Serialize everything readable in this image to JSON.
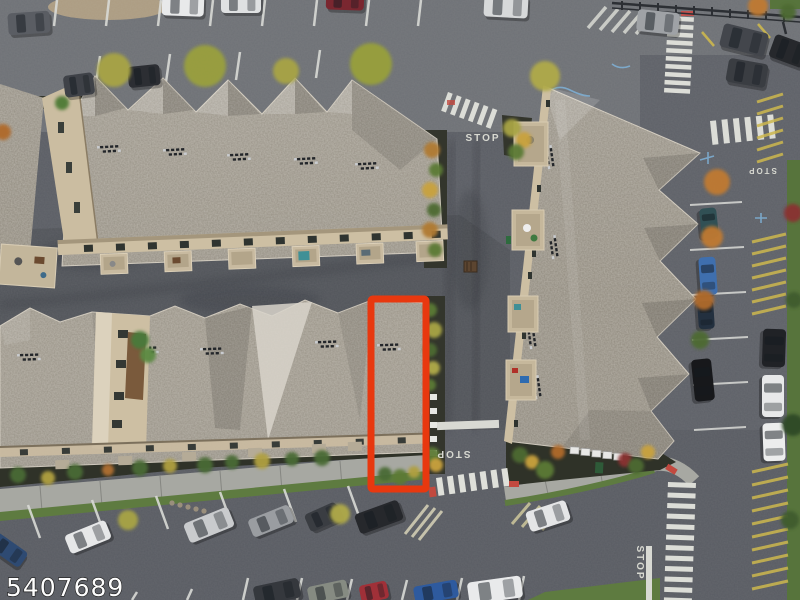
{
  "scene": {
    "description": "Aerial drone photo of a townhome community with gray shingle roofs, parking lots, roads with STOP markings and crosswalks; one townhouse unit is outlined with a red rectangle",
    "width": 800,
    "height": 600
  },
  "watermark": {
    "text": "5407689"
  },
  "highlight_box": {
    "color": "#e8380f",
    "x": 371,
    "y": 299,
    "width": 55,
    "height": 190,
    "stroke_width": 7
  },
  "road_markings": {
    "stop_label": "STOP",
    "stop_instances": 4,
    "marking_white": "#dcddd7",
    "curb_yellow": "#cdb84e",
    "curb_red": "#c2493f",
    "utility_blue": "#7fb2d8"
  },
  "palette": {
    "asphalt": "#5b5e65",
    "asphalt_light": "#6e7176",
    "roof": "#938d81",
    "roof_light": "#d8d4ca",
    "wall_tan": "#cdbfa3",
    "grass": "#5e7b40",
    "sidewalk": "#a7a8a2",
    "soil": "#31342a"
  },
  "vehicles": [
    {
      "cx": 29,
      "cy": 23,
      "l": 42,
      "w": 22,
      "rot": -4,
      "color": "#5a5d63"
    },
    {
      "cx": 183,
      "cy": 5,
      "l": 42,
      "w": 22,
      "rot": 2,
      "color": "#e8e9ea"
    },
    {
      "cx": 241,
      "cy": 3,
      "l": 40,
      "w": 20,
      "rot": 0,
      "color": "#dfe1e2"
    },
    {
      "cx": 345,
      "cy": 1,
      "l": 38,
      "w": 18,
      "rot": 2,
      "color": "#7a2730"
    },
    {
      "cx": 506,
      "cy": 6,
      "l": 44,
      "w": 23,
      "rot": 3,
      "color": "#d7d9da"
    },
    {
      "cx": 658,
      "cy": 22,
      "l": 42,
      "w": 22,
      "rot": 6,
      "color": "#9fa2a6"
    },
    {
      "cx": 744,
      "cy": 40,
      "l": 46,
      "w": 24,
      "rot": 14,
      "color": "#43464c"
    },
    {
      "cx": 789,
      "cy": 51,
      "l": 36,
      "w": 24,
      "rot": 20,
      "color": "#26282c"
    },
    {
      "cx": 79,
      "cy": 85,
      "l": 30,
      "w": 22,
      "rot": -8,
      "color": "#3f4248"
    },
    {
      "cx": 144,
      "cy": 76,
      "l": 32,
      "w": 21,
      "rot": -6,
      "color": "#2c2e33"
    },
    {
      "cx": 747,
      "cy": 73,
      "l": 40,
      "w": 24,
      "rot": 10,
      "color": "#3a3d42"
    },
    {
      "cx": 8,
      "cy": 550,
      "l": 38,
      "w": 18,
      "rot": 35,
      "color": "#2e4a72"
    },
    {
      "cx": 88,
      "cy": 537,
      "l": 44,
      "w": 20,
      "rot": -22,
      "color": "#e6e7e8"
    },
    {
      "cx": 209,
      "cy": 525,
      "l": 48,
      "w": 21,
      "rot": -22,
      "color": "#c9cbcd"
    },
    {
      "cx": 271,
      "cy": 521,
      "l": 44,
      "w": 19,
      "rot": -22,
      "color": "#9a9da1"
    },
    {
      "cx": 323,
      "cy": 517,
      "l": 34,
      "w": 19,
      "rot": -24,
      "color": "#3a3d42"
    },
    {
      "cx": 379,
      "cy": 517,
      "l": 46,
      "w": 21,
      "rot": -20,
      "color": "#26282c"
    },
    {
      "cx": 548,
      "cy": 516,
      "l": 42,
      "w": 21,
      "rot": -18,
      "color": "#e4e5e6"
    },
    {
      "cx": 277,
      "cy": 592,
      "l": 46,
      "w": 20,
      "rot": -12,
      "color": "#35383d"
    },
    {
      "cx": 328,
      "cy": 592,
      "l": 40,
      "w": 18,
      "rot": -12,
      "color": "#868b82"
    },
    {
      "cx": 374,
      "cy": 592,
      "l": 28,
      "w": 18,
      "rot": -12,
      "color": "#a03038"
    },
    {
      "cx": 436,
      "cy": 592,
      "l": 44,
      "w": 18,
      "rot": -10,
      "color": "#2e5a9e"
    },
    {
      "cx": 495,
      "cy": 590,
      "l": 54,
      "w": 22,
      "rot": -8,
      "color": "#e9eaeb"
    },
    {
      "cx": 709,
      "cy": 223,
      "l": 30,
      "w": 17,
      "rot": 84,
      "color": "#315055"
    },
    {
      "cx": 708,
      "cy": 276,
      "l": 38,
      "w": 17,
      "rot": 86,
      "color": "#3f6fae"
    },
    {
      "cx": 706,
      "cy": 315,
      "l": 28,
      "w": 16,
      "rot": 86,
      "color": "#23303f"
    },
    {
      "cx": 703,
      "cy": 380,
      "l": 42,
      "w": 20,
      "rot": 84,
      "color": "#17181b"
    },
    {
      "cx": 774,
      "cy": 348,
      "l": 38,
      "w": 23,
      "rot": 92,
      "color": "#202226"
    },
    {
      "cx": 773,
      "cy": 396,
      "l": 42,
      "w": 22,
      "rot": 90,
      "color": "#e7e8e9"
    },
    {
      "cx": 774,
      "cy": 442,
      "l": 38,
      "w": 22,
      "rot": 88,
      "color": "#eceded"
    }
  ],
  "trees": [
    {
      "cx": 114,
      "cy": 70,
      "r": 17,
      "color": "#a8a444"
    },
    {
      "cx": 205,
      "cy": 66,
      "r": 21,
      "color": "#9aa03c"
    },
    {
      "cx": 286,
      "cy": 71,
      "r": 13,
      "color": "#a8a444"
    },
    {
      "cx": 371,
      "cy": 64,
      "r": 21,
      "color": "#98a03a"
    },
    {
      "cx": 545,
      "cy": 76,
      "r": 15,
      "color": "#b0aa48"
    },
    {
      "cx": 432,
      "cy": 150,
      "r": 8,
      "color": "#b07a32"
    },
    {
      "cx": 436,
      "cy": 170,
      "r": 7,
      "color": "#5c7a36"
    },
    {
      "cx": 430,
      "cy": 190,
      "r": 8,
      "color": "#c9a23c"
    },
    {
      "cx": 434,
      "cy": 210,
      "r": 7,
      "color": "#4e6b33"
    },
    {
      "cx": 430,
      "cy": 230,
      "r": 8,
      "color": "#b07a32"
    },
    {
      "cx": 435,
      "cy": 250,
      "r": 7,
      "color": "#5c7a36"
    },
    {
      "cx": 430,
      "cy": 310,
      "r": 7,
      "color": "#5c7a36"
    },
    {
      "cx": 434,
      "cy": 330,
      "r": 8,
      "color": "#a8a444"
    },
    {
      "cx": 430,
      "cy": 350,
      "r": 7,
      "color": "#4e6b33"
    },
    {
      "cx": 433,
      "cy": 368,
      "r": 7,
      "color": "#b0aa48"
    },
    {
      "cx": 430,
      "cy": 385,
      "r": 6,
      "color": "#5c7a36"
    },
    {
      "cx": 432,
      "cy": 455,
      "r": 8,
      "color": "#5c7a36"
    },
    {
      "cx": 436,
      "cy": 465,
      "r": 7,
      "color": "#c9a23c"
    },
    {
      "cx": 512,
      "cy": 128,
      "r": 9,
      "color": "#a8a444"
    },
    {
      "cx": 524,
      "cy": 140,
      "r": 8,
      "color": "#c9a23c"
    },
    {
      "cx": 516,
      "cy": 152,
      "r": 8,
      "color": "#5c7a36"
    },
    {
      "cx": 717,
      "cy": 182,
      "r": 13,
      "color": "#c07a33"
    },
    {
      "cx": 712,
      "cy": 237,
      "r": 11,
      "color": "#c07a33"
    },
    {
      "cx": 704,
      "cy": 300,
      "r": 10,
      "color": "#b06a2c"
    },
    {
      "cx": 700,
      "cy": 340,
      "r": 9,
      "color": "#4e6b33"
    },
    {
      "cx": 793,
      "cy": 213,
      "r": 9,
      "color": "#8a3030"
    },
    {
      "cx": 794,
      "cy": 300,
      "r": 8,
      "color": "#3f5c2e"
    },
    {
      "cx": 793,
      "cy": 425,
      "r": 11,
      "color": "#2f4a26"
    },
    {
      "cx": 790,
      "cy": 520,
      "r": 9,
      "color": "#3f5c2e"
    },
    {
      "cx": 128,
      "cy": 520,
      "r": 10,
      "color": "#a8a444"
    },
    {
      "cx": 340,
      "cy": 514,
      "r": 10,
      "color": "#b0aa48"
    },
    {
      "cx": 520,
      "cy": 455,
      "r": 8,
      "color": "#4e6b33"
    },
    {
      "cx": 532,
      "cy": 462,
      "r": 7,
      "color": "#c9a23c"
    },
    {
      "cx": 545,
      "cy": 470,
      "r": 9,
      "color": "#5c7a36"
    },
    {
      "cx": 558,
      "cy": 452,
      "r": 7,
      "color": "#b06a2c"
    },
    {
      "cx": 625,
      "cy": 460,
      "r": 7,
      "color": "#8a3030"
    },
    {
      "cx": 636,
      "cy": 466,
      "r": 8,
      "color": "#4e6b33"
    },
    {
      "cx": 648,
      "cy": 452,
      "r": 7,
      "color": "#c9a23c"
    },
    {
      "cx": 18,
      "cy": 475,
      "r": 8,
      "color": "#4a6b35"
    },
    {
      "cx": 48,
      "cy": 478,
      "r": 7,
      "color": "#b0a040"
    },
    {
      "cx": 75,
      "cy": 472,
      "r": 8,
      "color": "#4a6b35"
    },
    {
      "cx": 108,
      "cy": 470,
      "r": 6,
      "color": "#b07030"
    },
    {
      "cx": 140,
      "cy": 468,
      "r": 8,
      "color": "#4a6b35"
    },
    {
      "cx": 170,
      "cy": 466,
      "r": 7,
      "color": "#b0a040"
    },
    {
      "cx": 205,
      "cy": 465,
      "r": 8,
      "color": "#4a6b35"
    },
    {
      "cx": 232,
      "cy": 462,
      "r": 7,
      "color": "#4a6b35"
    },
    {
      "cx": 262,
      "cy": 461,
      "r": 8,
      "color": "#b0a040"
    },
    {
      "cx": 292,
      "cy": 459,
      "r": 7,
      "color": "#4a6b35"
    },
    {
      "cx": 322,
      "cy": 458,
      "r": 8,
      "color": "#4a6b35"
    },
    {
      "cx": 385,
      "cy": 474,
      "r": 7,
      "color": "#4a6b35"
    },
    {
      "cx": 400,
      "cy": 477,
      "r": 8,
      "color": "#5c7a36"
    },
    {
      "cx": 414,
      "cy": 472,
      "r": 6,
      "color": "#b0a040"
    },
    {
      "cx": 140,
      "cy": 340,
      "r": 9,
      "color": "#4a7a3a"
    },
    {
      "cx": 148,
      "cy": 355,
      "r": 8,
      "color": "#5c8a42"
    },
    {
      "cx": 758,
      "cy": 6,
      "r": 10,
      "color": "#c07a33"
    },
    {
      "cx": 788,
      "cy": 12,
      "r": 8,
      "color": "#4e6b33"
    },
    {
      "cx": 3,
      "cy": 132,
      "r": 8,
      "color": "#b06a2c"
    },
    {
      "cx": 62,
      "cy": 103,
      "r": 7,
      "color": "#4e7a36"
    }
  ]
}
